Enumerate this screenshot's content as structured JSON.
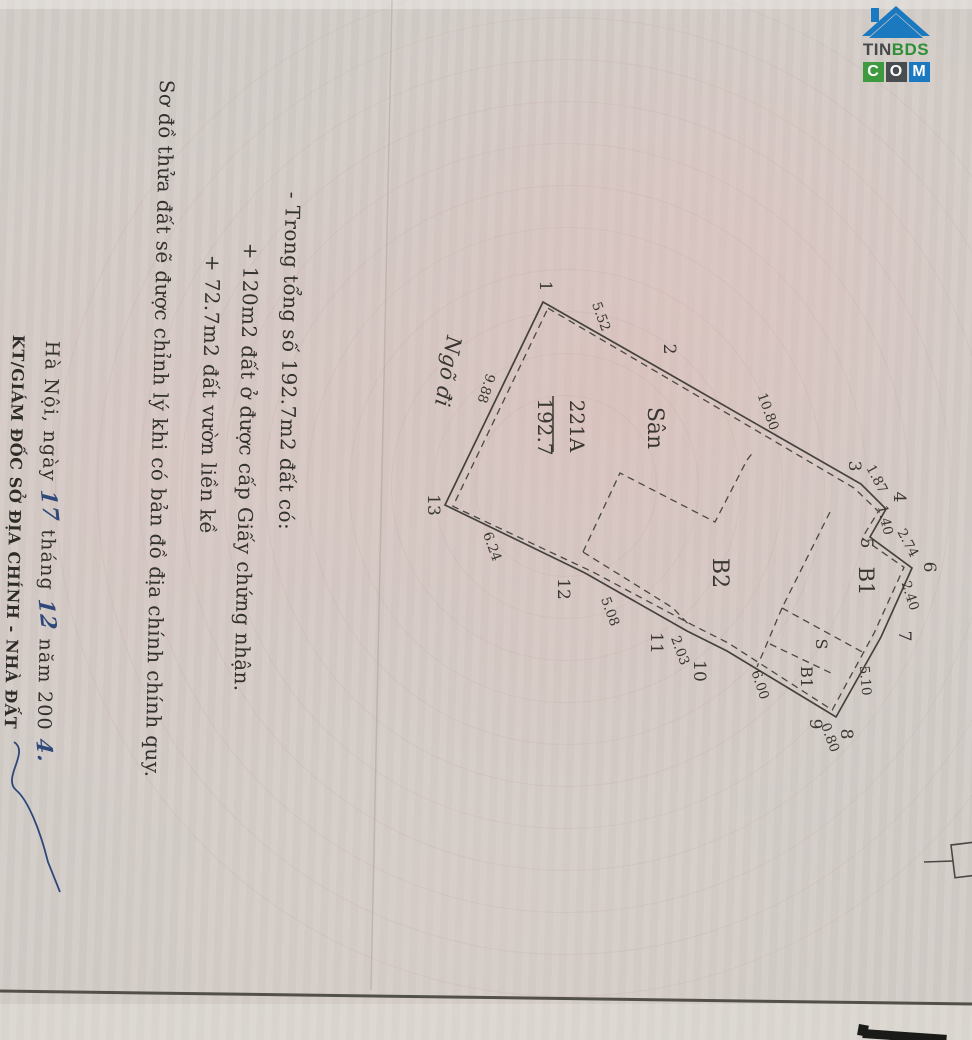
{
  "logo": {
    "brand_dark": "TIN",
    "brand_green": "BDS",
    "blocks": [
      "C",
      "O",
      "M"
    ]
  },
  "title": "Sơ đồ thửa đất sẽ được chỉnh lý khi có bản đồ địa chính chính quy.",
  "notes": {
    "intro": "- Trong tổng số 192.7m2 đất có:",
    "item1": "+ 120m2 đất ở được cấp Giấy chứng nhận.",
    "item2": "+ 72.7m2 đất vườn liền kề"
  },
  "signature": {
    "place_date": {
      "p1": "Hà Nội, ngày",
      "day": "17",
      "p2": "tháng",
      "month": "12",
      "p3": "năm 200",
      "year": "4."
    },
    "signer_title": "KT/GIÁM ĐỐC SỞ ĐỊA CHÍNH - NHÀ ĐẤT"
  },
  "diagram": {
    "parcel_number": "221A",
    "parcel_area": "192.7",
    "alley_label": "Ngõ đi",
    "room_labels": [
      "Sân",
      "B2",
      "B1",
      "S",
      "B1"
    ],
    "vertex_labels": [
      "1",
      "2",
      "3",
      "4",
      "5",
      "6",
      "7",
      "8",
      "9",
      "10",
      "11",
      "12",
      "13"
    ],
    "edge_lengths": [
      "5.52",
      "10.80",
      "1.87",
      "1.40",
      "2.74",
      "2.40",
      "5.10",
      "0.80",
      "6.00",
      "2.03",
      "5.08",
      "6.24",
      "9.88"
    ]
  }
}
